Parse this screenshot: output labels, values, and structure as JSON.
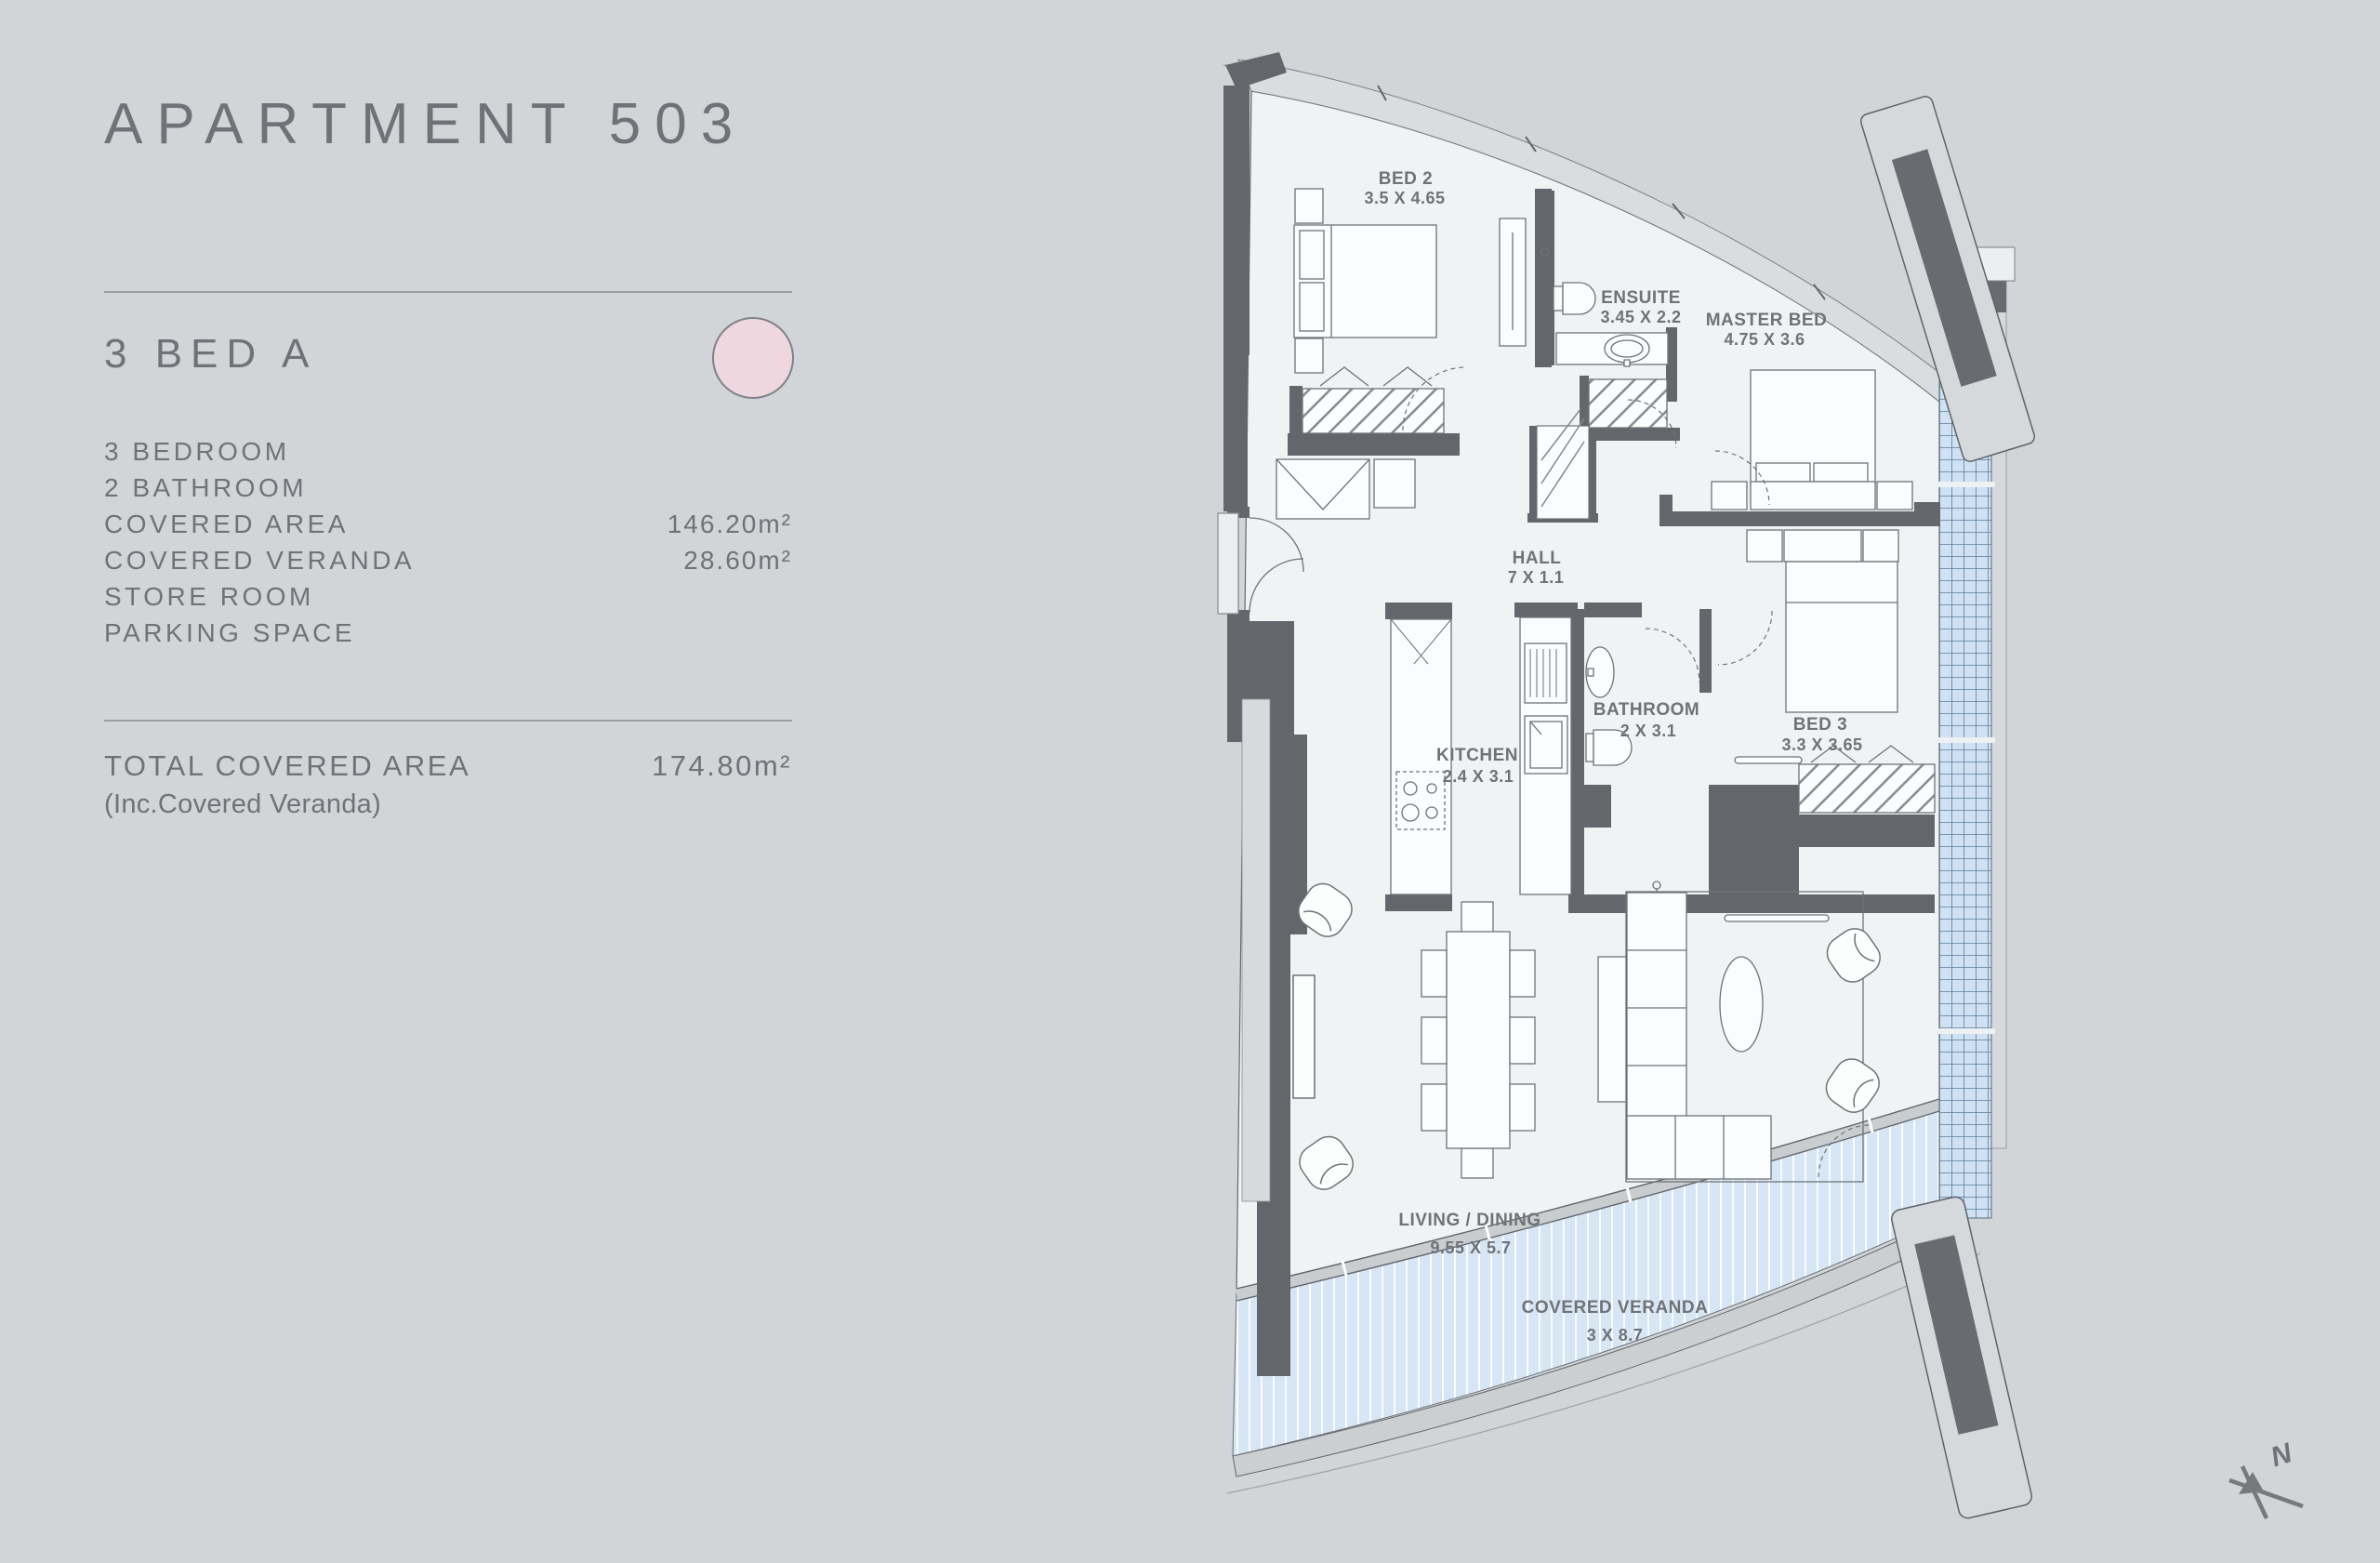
{
  "panel": {
    "title": "APARTMENT 503",
    "unit_type": "3 BED A",
    "accent_color": "#eed7de",
    "details": [
      {
        "label": "3 BEDROOM",
        "value": ""
      },
      {
        "label": "2 BATHROOM",
        "value": ""
      },
      {
        "label": "COVERED AREA",
        "value": "146.20m²"
      },
      {
        "label": "COVERED VERANDA",
        "value": "28.60m²"
      },
      {
        "label": "STORE ROOM",
        "value": ""
      },
      {
        "label": "PARKING SPACE",
        "value": ""
      }
    ],
    "total": {
      "label": "TOTAL COVERED AREA",
      "value": "174.80m²",
      "note": "(Inc.Covered Veranda)"
    }
  },
  "floorplan": {
    "rooms": [
      {
        "name": "BED 2",
        "dims": "3.5 X 4.65"
      },
      {
        "name": "ENSUITE",
        "dims": "3.45 X 2.2"
      },
      {
        "name": "MASTER BED",
        "dims": "4.75 X 3.6"
      },
      {
        "name": "HALL",
        "dims": "7 X 1.1"
      },
      {
        "name": "KITCHEN",
        "dims": "2.4 X 3.1"
      },
      {
        "name": "BATHROOM",
        "dims": "2 X 3.1"
      },
      {
        "name": "BED 3",
        "dims": "3.3 X 3.65"
      },
      {
        "name": "LIVING / DINING",
        "dims": "9.55 X 5.7"
      },
      {
        "name": "COVERED VERANDA",
        "dims": "3 X 8.7"
      }
    ],
    "compass": {
      "label": "N"
    },
    "colors": {
      "veranda_fill": "#d6e6f5",
      "window_grid": "#cfe1f3",
      "wall": "#63676b",
      "floor": "#f1f2f3",
      "background": "#d1d5d8"
    }
  }
}
